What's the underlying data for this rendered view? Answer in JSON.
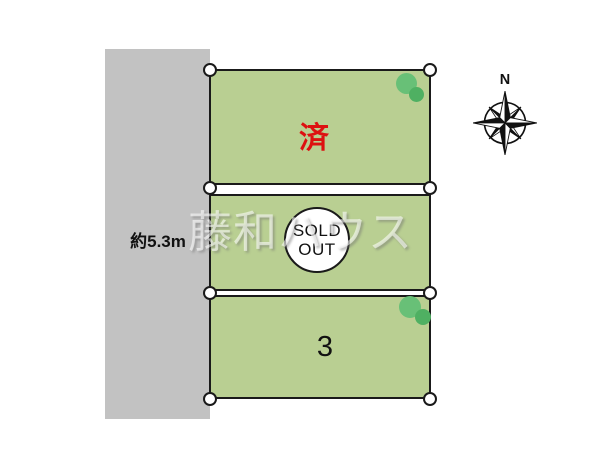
{
  "title": "land-plot-layout-map",
  "colors": {
    "background": "#ffffff",
    "road_gray": "#c2c2c2",
    "parcel_green": "#b9cf92",
    "border_black": "#1a1a1a",
    "sold_red": "#dd1111",
    "tree_green_light": "#68c077",
    "tree_green_dark": "#4fb062",
    "watermark_white": "rgba(255,255,255,0.58)"
  },
  "road": {
    "width_label": "約5.3m"
  },
  "compass": {
    "north_label": "N"
  },
  "watermark": {
    "text": "藤和ハウス"
  },
  "parcels": [
    {
      "name": "parcel-1",
      "status_label": "済"
    },
    {
      "name": "parcel-2",
      "badge_line1": "SOLD",
      "badge_line2": "OUT"
    },
    {
      "name": "parcel-3",
      "number_label": "3"
    }
  ]
}
